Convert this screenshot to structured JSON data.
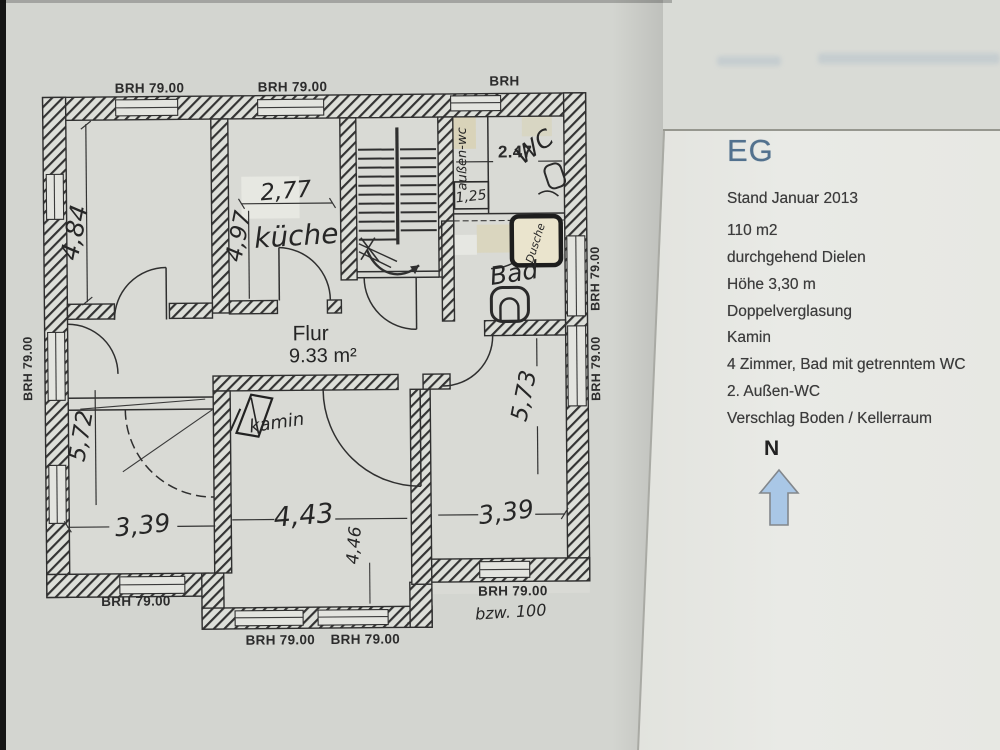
{
  "colors": {
    "paper": "#d3d5d0",
    "page": "#e8e9e5",
    "ink": "#2c2c2c",
    "title_blue": "#52718e",
    "north_arrow_fill": "#a9c7e6"
  },
  "info_panel": {
    "title": "EG",
    "date_line": "Stand Januar 2013",
    "features": [
      "110 m2",
      "durchgehend Dielen",
      "Höhe 3,30 m",
      "Doppelverglasung",
      "Kamin",
      "4 Zimmer, Bad mit getrenntem WC",
      "2. Außen-WC",
      "Verschlag Boden / Kellerraum"
    ],
    "north_label": "N"
  },
  "floorplan": {
    "room_labels": {
      "flur": "Flur",
      "flur_area": "9.33 m²",
      "kueche": "küche",
      "bad": "Bad",
      "wc": "WC",
      "aussen_wc": "außen-wc",
      "dusche": "Dusche",
      "kamin": "kamin"
    },
    "dimensions": {
      "d_484": "4,84",
      "d_277": "2,77",
      "d_497": "4,97",
      "d_247": "2.47",
      "d_125": "1,25",
      "d_572": "5,72",
      "d_339_left": "3,39",
      "d_443": "4,43",
      "d_446": "4,46",
      "d_339_right": "3,39",
      "d_573": "5,73"
    },
    "sill_labels": {
      "top_1": "BRH 79.00",
      "top_2": "BRH 79.00",
      "top_3": "BRH",
      "left": "BRH 79.00",
      "right_1": "BRH 79.00",
      "right_2": "BRH 79.00",
      "bottom_left": "BRH 79.00",
      "bottom_right": "BRH 79.00",
      "bottom_right_note": "bzw. 100",
      "bay_1": "BRH 79.00",
      "bay_2": "BRH 79.00"
    }
  }
}
